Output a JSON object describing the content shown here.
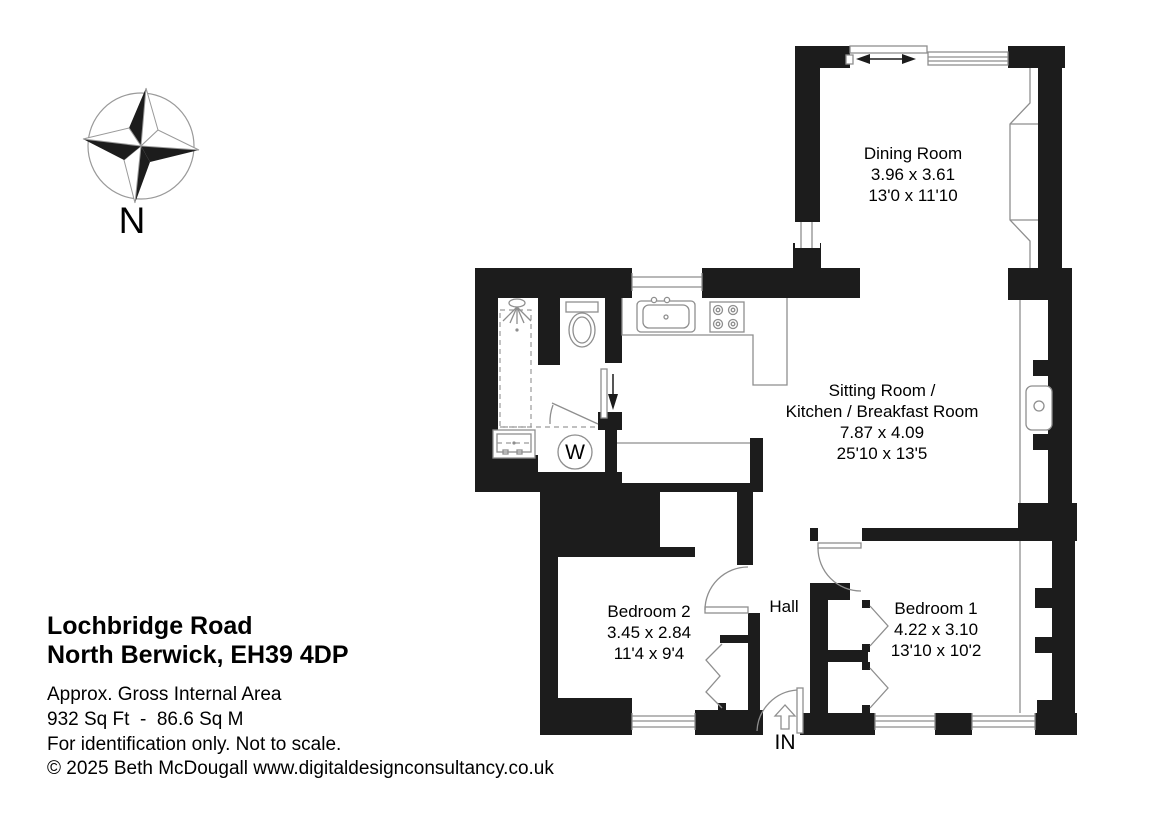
{
  "title_block": {
    "address_line1": "Lochbridge Road",
    "address_line2": "North Berwick, EH39 4DP",
    "area_label": "Approx. Gross Internal Area",
    "area_value": "932 Sq Ft  -  86.6 Sq M",
    "disclaimer": "For identification only. Not to scale.",
    "copyright": "© 2025 Beth McDougall www.digitaldesignconsultancy.co.uk"
  },
  "compass": {
    "north_label": "N"
  },
  "rooms": {
    "dining": {
      "name": "Dining Room",
      "metric": "3.96 x 3.61",
      "imperial": "13'0 x 11'10"
    },
    "sitting": {
      "name_line1": "Sitting Room /",
      "name_line2": "Kitchen / Breakfast Room",
      "metric": "7.87 x 4.09",
      "imperial": "25'10 x 13'5"
    },
    "bedroom2": {
      "name": "Bedroom 2",
      "metric": "3.45 x 2.84",
      "imperial": "11'4 x 9'4"
    },
    "bedroom1": {
      "name": "Bedroom 1",
      "metric": "4.22 x 3.10",
      "imperial": "13'10 x 10'2"
    },
    "hall": {
      "name": "Hall"
    }
  },
  "markers": {
    "entrance": "IN",
    "washing_machine": "W"
  },
  "colors": {
    "wall": "#1c1c1c",
    "fixture_line": "#8e8e8e",
    "text": "#000000",
    "background": "#ffffff"
  }
}
